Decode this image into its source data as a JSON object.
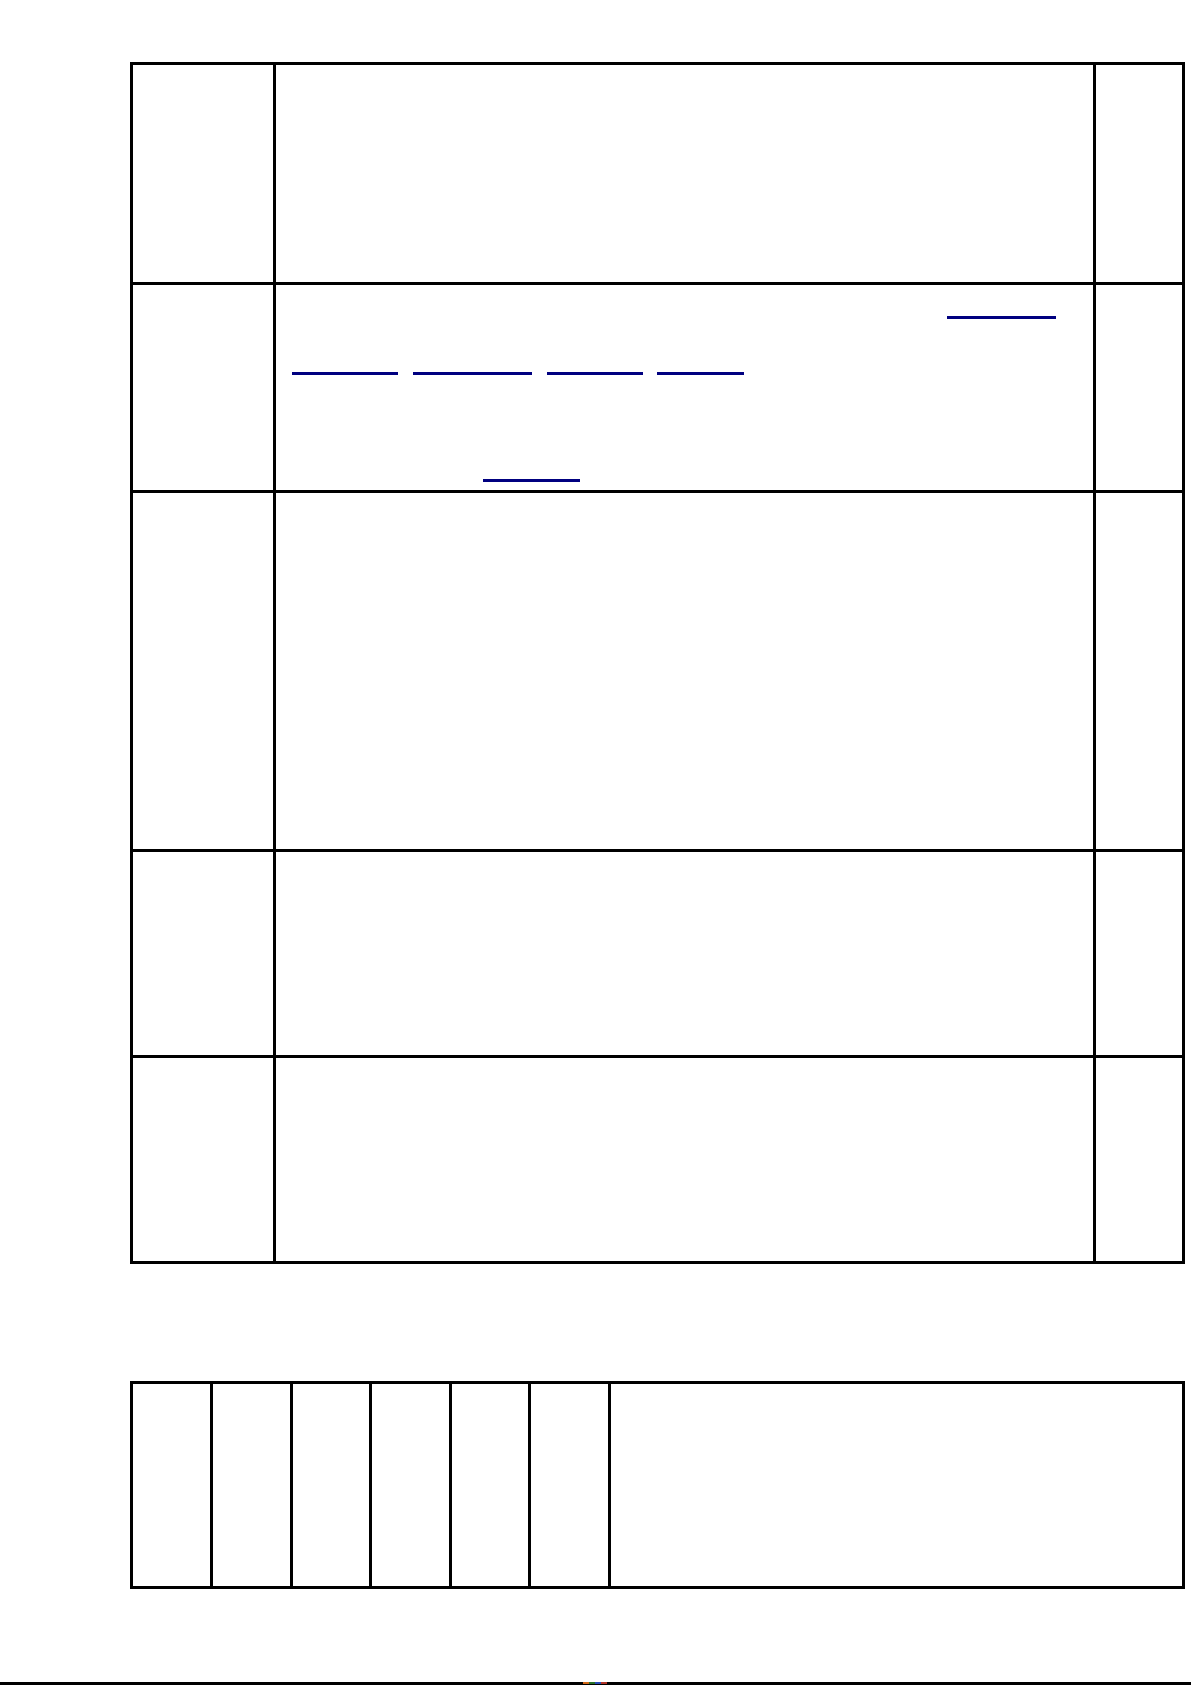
{
  "page": {
    "background": "#ffffff",
    "bottom_edge_bar_color": "#000000",
    "bottom_edge_speck_colors": [
      "#e8731a",
      "#2a7d2a",
      "#2a55c8",
      "#c0392b"
    ]
  },
  "colors": {
    "table_border": "#000000",
    "hyperlink_underline": "#000080"
  },
  "top_table": {
    "row_count": 5,
    "col_count": 3,
    "cells": [
      [
        "",
        "",
        ""
      ],
      [
        "",
        "",
        ""
      ],
      [
        "",
        "",
        ""
      ],
      [
        "",
        "",
        ""
      ],
      [
        "",
        "",
        ""
      ]
    ]
  },
  "hyperlinks": {
    "row2_top_right": [
      {
        "text": ""
      }
    ],
    "row2_middle_row": [
      {
        "text": ""
      },
      {
        "text": ""
      },
      {
        "text": ""
      },
      {
        "text": ""
      }
    ],
    "row2_bottom": [
      {
        "text": ""
      }
    ]
  },
  "bottom_table": {
    "row_count": 1,
    "col_count": 7,
    "cells": [
      [
        "",
        "",
        "",
        "",
        "",
        "",
        ""
      ]
    ]
  }
}
